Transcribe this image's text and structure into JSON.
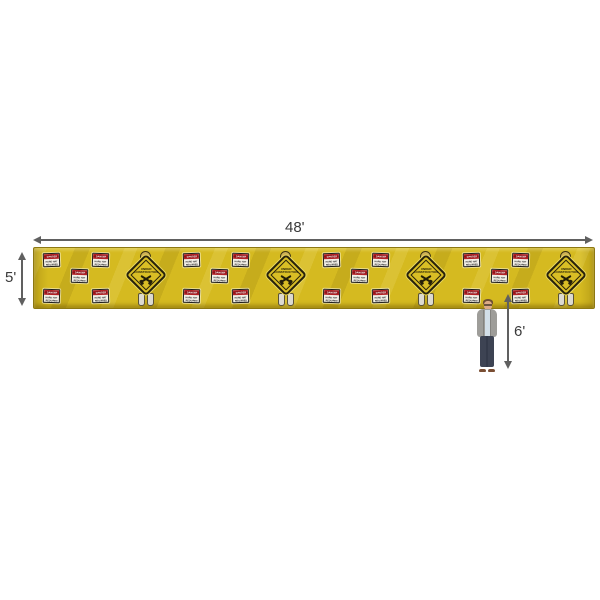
{
  "scene": {
    "background": "#ffffff"
  },
  "dimensions": {
    "width_label": "48'",
    "height_label": "5'",
    "person_height_label": "6'",
    "arrow_color": "#606060"
  },
  "banner": {
    "color": "#d5ba20",
    "repeat_count": 4,
    "danger_sign": {
      "header": "DANGER",
      "line1": "HARD HAT",
      "line2": "REQUIRED",
      "header_bg": "#b42025",
      "face_color": "#f3f0e8"
    },
    "diamond_sign": {
      "line1": "UNDER",
      "line2": "CONSTRUCTION",
      "icon": "crossed-hammers-icon",
      "color": "#d9be25"
    }
  }
}
